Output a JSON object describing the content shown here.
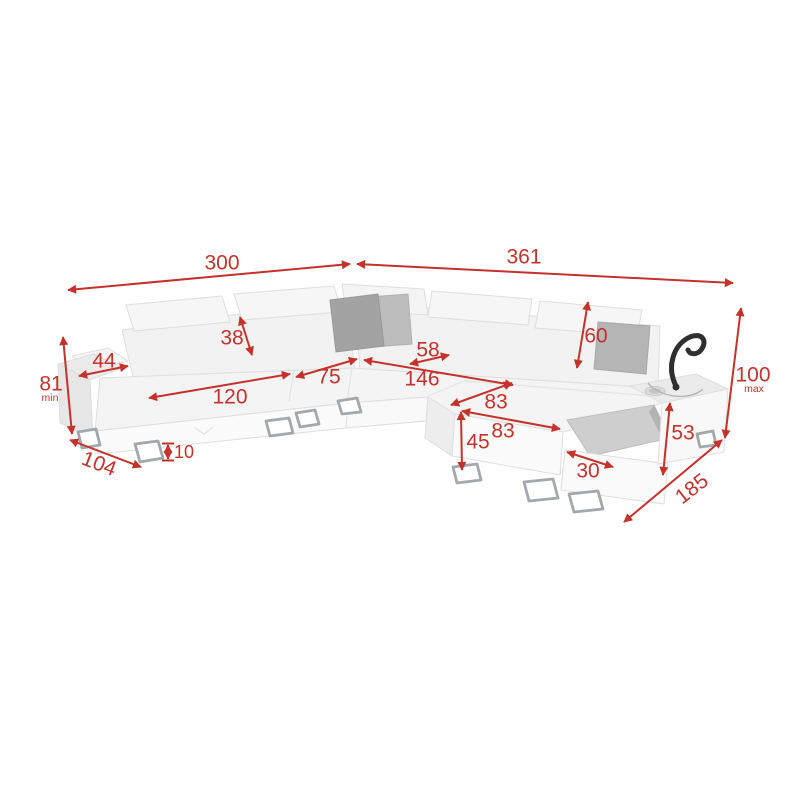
{
  "diagram": {
    "background": "#ffffff",
    "accent": "#c5312b",
    "sofa_body_color": "#f3f3f3",
    "pillow_color": "#b0b0b0",
    "dims": {
      "w_left": {
        "value": "300"
      },
      "w_right": {
        "value": "361"
      },
      "h_min": {
        "value": "81",
        "qualifier": "min"
      },
      "h_max": {
        "value": "100",
        "qualifier": "max"
      },
      "armrest": {
        "value": "44"
      },
      "headrest": {
        "value": "38"
      },
      "seat_left": {
        "value": "120"
      },
      "seat_corner": {
        "value": "75"
      },
      "back_depth": {
        "value": "58"
      },
      "seat_right": {
        "value": "146"
      },
      "back_height": {
        "value": "60"
      },
      "chaise_top": {
        "value": "83"
      },
      "chaise_front": {
        "value": "83"
      },
      "front_height": {
        "value": "45"
      },
      "drawer": {
        "value": "30"
      },
      "storage": {
        "value": "53"
      },
      "depth_left": {
        "value": "104"
      },
      "leg": {
        "value": "10"
      },
      "depth_right": {
        "value": "185"
      }
    }
  }
}
